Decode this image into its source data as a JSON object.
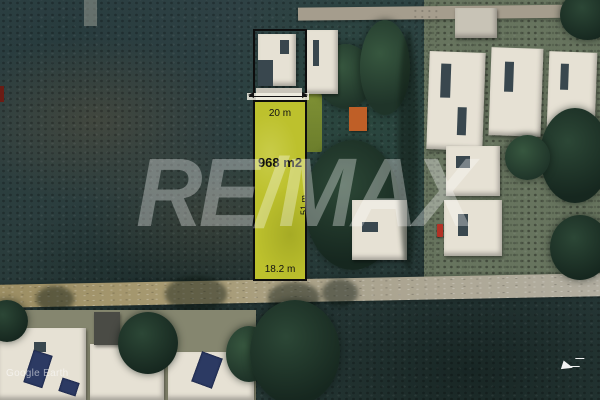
{
  "photo": {
    "description": "Aerial satellite view of a residential land lot for sale"
  },
  "lot": {
    "front_label": "20 m",
    "area_label": "968 m2",
    "depth_label": "51 m",
    "rear_label": "18.2 m",
    "fill_color": "#bdc12d",
    "outline_color": "#0d0d0d"
  },
  "watermark": {
    "brand": "RE/MAX",
    "color": "#ffffff"
  },
  "attribution": {
    "source": "Google Earth"
  }
}
